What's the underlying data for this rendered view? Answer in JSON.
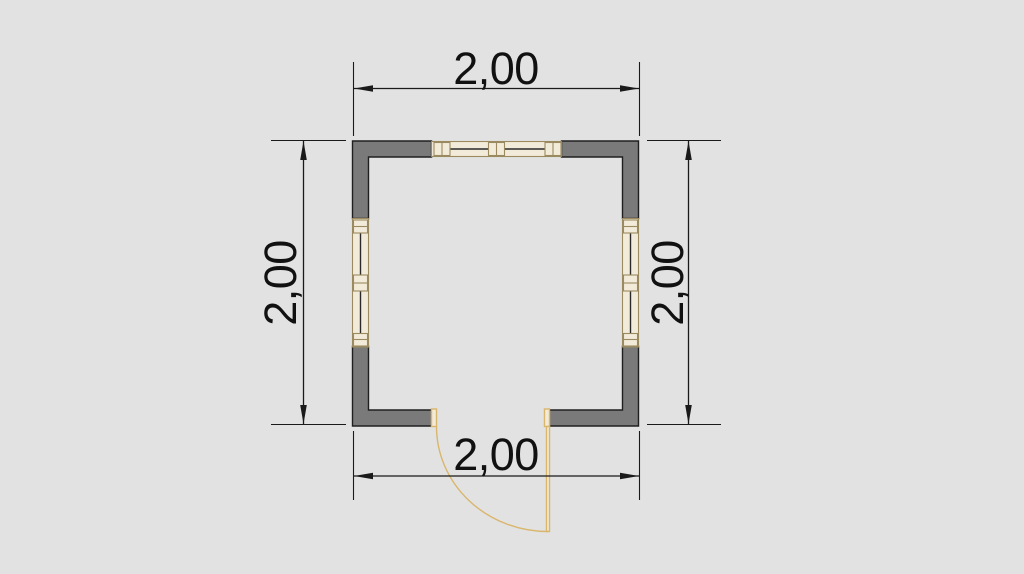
{
  "plan": {
    "type": "floor-plan",
    "elements": [
      "exterior-walls",
      "window-north",
      "window-west",
      "window-east",
      "door-south-with-swing"
    ],
    "dimensions": {
      "top": {
        "label": "2,00"
      },
      "bottom": {
        "label": "2,00"
      },
      "left": {
        "label": "2,00"
      },
      "right": {
        "label": "2,00"
      }
    }
  },
  "colors": {
    "background": "#e2e2e2",
    "wall_fill": "#7a7a7a",
    "wall_outline": "#1f1f1f",
    "dimension_line": "#1a1a1a",
    "dimension_text": "#111111",
    "window_frame": "#9b8a60",
    "window_fill": "#f2ebd9",
    "glass_line": "#2a2a2a",
    "door": "#d9b66b"
  }
}
